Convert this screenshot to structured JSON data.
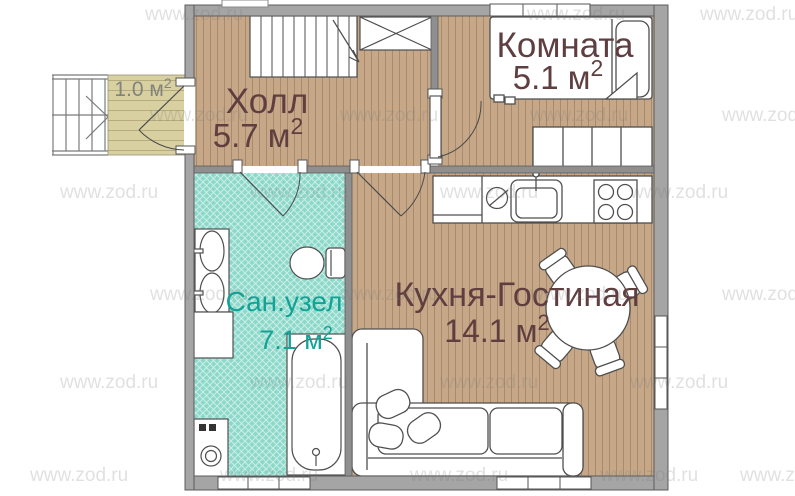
{
  "watermark": {
    "text": "www.zod.ru"
  },
  "rooms": {
    "hall": {
      "name": "Холл",
      "area": "5.7 м",
      "area_sup": "2"
    },
    "bedroom": {
      "name": "Комната",
      "area": "5.1 м",
      "area_sup": "2"
    },
    "kitchen_living": {
      "name": "Кухня-Гостиная",
      "area": "14.1 м",
      "area_sup": "2"
    },
    "bathroom": {
      "name": "Сан.узел",
      "area": "7.1 м",
      "area_sup": "2"
    },
    "porch": {
      "area": "1.0 м",
      "area_sup": "2"
    }
  },
  "colors": {
    "wood_floor": "#c6a888",
    "porch_floor": "#d9d0a2",
    "bathroom_tile": "#8cd9ca",
    "wall": "#a5a5a5",
    "label_brown": "#5f3e40",
    "label_teal": "#13a295",
    "label_gray": "#82837b"
  }
}
